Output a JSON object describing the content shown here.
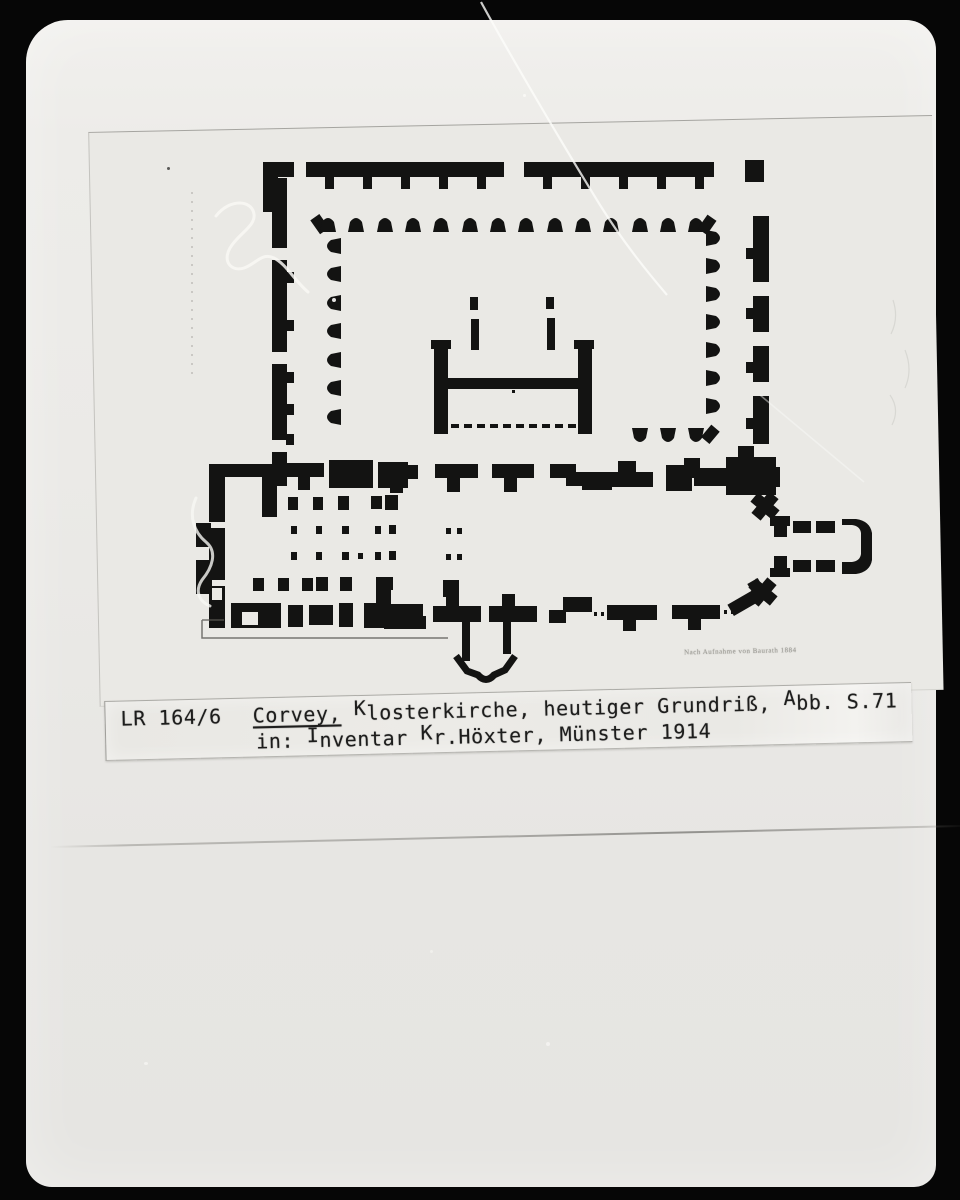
{
  "photo_card": {
    "caption": {
      "archive_id": "LR 164/6",
      "title": "Corvey,",
      "line1_k": "K",
      "line1_after_k": "losterkirche, heutiger Grundriß, ",
      "line1_a": "A",
      "line1_end": "bb. S.71",
      "line2_start": "in: ",
      "line2_i": "I",
      "line2_after_i": "nventar ",
      "line2_k": "K",
      "line2_end": "r.Höxter, Münster 1914"
    },
    "plan_credit": "Nach Aufnahme von Baurath 1884",
    "colors": {
      "frame": "#060606",
      "photo_paper": "#ebeae7",
      "page_paper": "#eae9e5",
      "ink": "#0c0c0b",
      "caption_text": "#1d1d1c"
    }
  }
}
